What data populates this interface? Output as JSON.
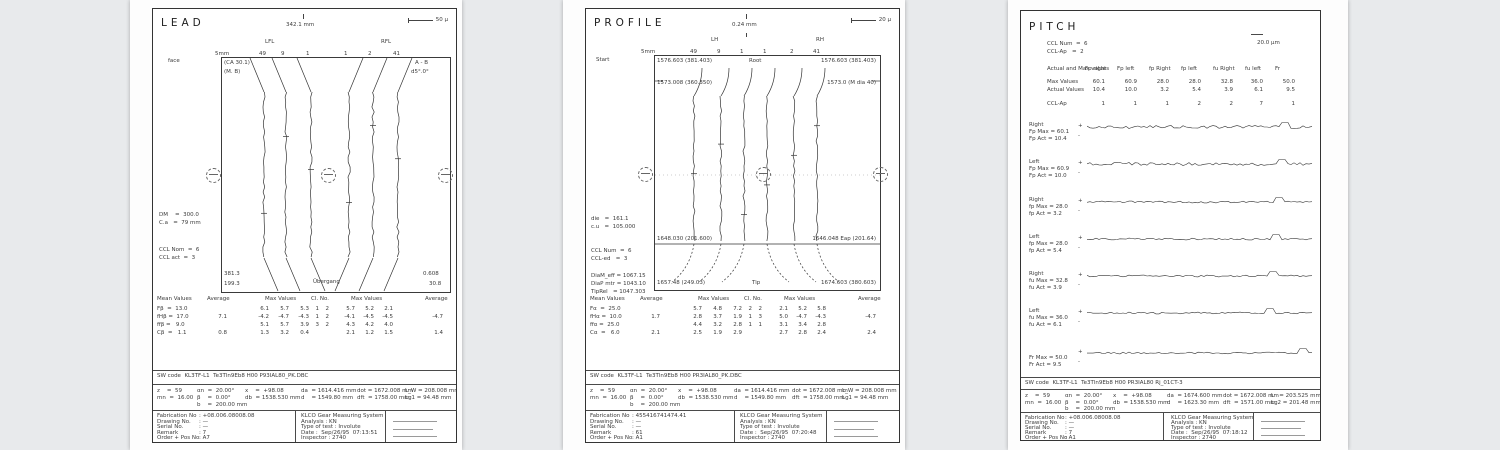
{
  "colors": {
    "background": "#e8eaec",
    "paper": "#ffffff",
    "ink": "#3b3b3b"
  },
  "pages": [
    {
      "title": "LEAD",
      "dim": "342.1 mm",
      "scale": "50 μ",
      "flank_l": "LFL",
      "flank_r": "RFL",
      "axis1": "5mm",
      "axis2": "face",
      "teeth": [
        "49",
        "9",
        "1",
        "1",
        "2",
        "41"
      ],
      "labels": {
        "tl1": "(CA 30.1)",
        "tl2": "(M. B)",
        "tr1": "A - B",
        "tr2": "d5°.0°",
        "bl1": "381.3",
        "bl2": "199.3",
        "br1": "0.608",
        "br2": "30.8",
        "bc": "Übergang"
      },
      "info1": [
        "DM    =  300.0",
        "C.a   =  79 mm"
      ],
      "info2": [
        "CCL Nom  =  6",
        "CCL act  =  3"
      ],
      "table": {
        "headers": [
          "Mean Values",
          "Average",
          "Max Values",
          "Cl. No.",
          "Max Values",
          "Average"
        ],
        "rows": [
          [
            "Fβ  =  13.0",
            "",
            "6.1",
            "5.7",
            "5.3",
            "1",
            "2",
            "5.7",
            "5.2",
            "2.1",
            ""
          ],
          [
            "fHβ =  17.0",
            "7.1",
            "-4.2",
            "-4.7",
            "-4.3",
            "1",
            "2",
            "-4.1",
            "-4.5",
            "-4.5",
            "-4.7"
          ],
          [
            "ffβ =   9.0",
            "",
            "5.1",
            "5.7",
            "3.9",
            "3",
            "2",
            "4.3",
            "4.2",
            "4.0",
            ""
          ],
          [
            "Cβ  =   1.1",
            "0.8",
            "1.3",
            "3.2",
            "0.4",
            "",
            "",
            "2.1",
            "1.2",
            "1.5",
            "1.4"
          ]
        ]
      },
      "sw": "SW code  KL3TF-L1  Te3Tln9Eb8 H00 P93IAL80_PK.DBC",
      "params": [
        [
          "z    =  59",
          "αn  =  20.00°",
          "x    =  +98.08",
          "da  = 1614.416 mm",
          "dot = 1672.008 mm",
          "L_W = 208.008 mm"
        ],
        [
          "mn  =  16.00",
          "β    =  0.00°",
          "db  = 1538.530 mm",
          "d    = 1549.80 mm",
          "dft  = 1758.00 mm",
          "Lg1 = 94.48 mm"
        ],
        [
          "",
          "b    =  200.00 mm"
        ]
      ],
      "footer": {
        "labels": [
          "Fabrication No",
          "Drawing No.",
          "Serial No.",
          "Remark",
          "Order + Pos No"
        ],
        "values": [
          ": +08.006.08008.08",
          ": —",
          ": —",
          ": 7",
          ": A7"
        ],
        "system": [
          "KLCO Gear Measuring System",
          "Analysis : KN",
          "Type of test : Involute",
          "Date :  Sep/26/95  07:13:51",
          "Inspector : 2740"
        ]
      }
    },
    {
      "title": "PROFILE",
      "dim": "0.24 mm",
      "scale": "20 μ",
      "flank_l": "LH",
      "flank_r": "RH",
      "axis1": "5mm",
      "axis2": "Start",
      "teeth": [
        "49",
        "9",
        "1",
        "1",
        "2",
        "41"
      ],
      "labels": {
        "t_l": "1576.603 (381.403)",
        "t_c": "Root",
        "t_r": "1576.603 (381.403)",
        "t2_l": "1573.008 (360.350)",
        "t2_r": "1573.0 (M dia 40)",
        "m_l": "1648.030 (201.600)",
        "m_r": "1646.048 Eap (201.64)",
        "b_l": "1657.48 (249.03)",
        "b_c": "Tip",
        "b_r": "1674.603 (380.603)"
      },
      "info1": [
        "die   =  161.1",
        "c.u   =  105.000"
      ],
      "info2": [
        "CCL Num  =  6",
        "CCL-ed   =  3"
      ],
      "info3": [
        "DiaM_eff = 1067.15",
        "DiaP mtr = 1043.10",
        "TipRel   = 1047.303"
      ],
      "table": {
        "headers": [
          "Mean Values",
          "Average",
          "Max Values",
          "Cl. No.",
          "Max Values",
          "Average"
        ],
        "rows": [
          [
            "Fα  =  25.0",
            "",
            "5.7",
            "4.8",
            "7.2",
            "2",
            "2",
            "2.1",
            "5.2",
            "5.8",
            ""
          ],
          [
            "fHα =  10.0",
            "1.7",
            "2.8",
            "3.7",
            "1.9",
            "1",
            "3",
            "5.0",
            "-4.7",
            "-4.3",
            "-4.7"
          ],
          [
            "ffα =  25.0",
            "",
            "4.4",
            "3.2",
            "2.8",
            "1",
            "1",
            "3.1",
            "3.4",
            "2.8",
            ""
          ],
          [
            "Cα  =   6.0",
            "2.1",
            "2.5",
            "1.9",
            "2.9",
            "",
            "",
            "2.7",
            "2.8",
            "2.4",
            "2.4"
          ]
        ]
      },
      "sw": "SW code  KL3TF-L1  Te3Tln9Eb8 H00 PR3IAL80_PK.DBC",
      "params": [
        [
          "z    =  59",
          "αn  =  20.00°",
          "x    =  +98.08",
          "da  = 1614.416 mm",
          "dot = 1672.008 mm",
          "L_W = 208.008 mm"
        ],
        [
          "mn  =  16.00",
          "β    =  0.00°",
          "db  = 1538.530 mm",
          "d    = 1549.80 mm",
          "dft  = 1758.00 mm",
          "Lg1 = 94.48 mm"
        ],
        [
          "",
          "b    =  200.00 mm"
        ]
      ],
      "footer": {
        "labels": [
          "Fabrication No",
          "Drawing No.",
          "Serial No.",
          "Remark",
          "Order + Pos No"
        ],
        "values": [
          ": 455416741474.41",
          ": —",
          ": —",
          ": 61",
          ": A1"
        ],
        "system": [
          "KLCO Gear Measuring System",
          "Analysis : KN",
          "Type of test : Involute",
          "Date :  Sep/26/95  07:20:48",
          "Inspector : 2740"
        ]
      }
    },
    {
      "title": "PITCH",
      "scale": "20.0 μm",
      "ccl": [
        "CCL Num  =  6",
        "CCL-Ap   =  2"
      ],
      "tickp": "+",
      "tickm": "-",
      "ptable": {
        "corner": "Actual and Max values",
        "cols": [
          "Fp right",
          "Fp left",
          "fp Right",
          "fp left",
          "fu Right",
          "fu left",
          "Fr"
        ],
        "rows": [
          [
            "Max Values",
            "60.1",
            "60.9",
            "28.0",
            "28.0",
            "32.8",
            "36.0",
            "50.0"
          ],
          [
            "Actual Values",
            "10.4",
            "10.0",
            "3.2",
            "5.4",
            "3.9",
            "6.1",
            "9.5"
          ],
          [
            "CCL-Ap",
            "1",
            "1",
            "1",
            "2",
            "2",
            "7",
            "1"
          ]
        ]
      },
      "sections": [
        {
          "side": "Right",
          "max": "Fp Max = 60.1",
          "act": "Fp Act = 10.4"
        },
        {
          "side": "Left",
          "max": "Fp Max = 60.9",
          "act": "Fp Act = 10.0"
        },
        {
          "side": "Right",
          "max": "fp Max = 28.0",
          "act": "fp Act = 3.2"
        },
        {
          "side": "Left",
          "max": "fp Max = 28.0",
          "act": "fp Act = 5.4"
        },
        {
          "side": "Right",
          "max": "fu Max = 32.8",
          "act": "fu Act = 3.9"
        },
        {
          "side": "Left",
          "max": "fu Max = 36.0",
          "act": "fu Act = 6.1"
        },
        {
          "side": "",
          "max": "Fr Max = 50.0",
          "act": "Fr Act = 9.5"
        }
      ],
      "sw": "SW code  KL3TF-L1  Te3Tln9Eb8 H00 PR3IAL80 Rj_01CT-3",
      "params": [
        [
          "z    =  59",
          "αn  =  20.00°",
          "x    =  +98.08",
          "da  = 1674.600 mm",
          "dot = 1672.008 mm",
          "L   = 203.525 mm"
        ],
        [
          "mn  =  16.00",
          "β    =  0.00°",
          "db  = 1538.530 mm",
          "d    = 1623.30 mm",
          "dft  = 1571.00 mm",
          "Lg2 = 201.48 mm"
        ],
        [
          "",
          "b    =  200.00 mm"
        ]
      ],
      "footer": {
        "labels": [
          "Fabrication No",
          "Drawing No.",
          "Serial No.",
          "Remark",
          "Order + Pos No"
        ],
        "values": [
          ": +08.006.08008.08",
          ": —",
          ": —",
          ": 7",
          ": A1"
        ],
        "system": [
          "KLCO Gear Measuring System",
          "Analysis : KN",
          "Type of test : Involute",
          "Date :  Sep/26/95  07:18:12",
          "Inspector : 2740"
        ]
      }
    }
  ]
}
